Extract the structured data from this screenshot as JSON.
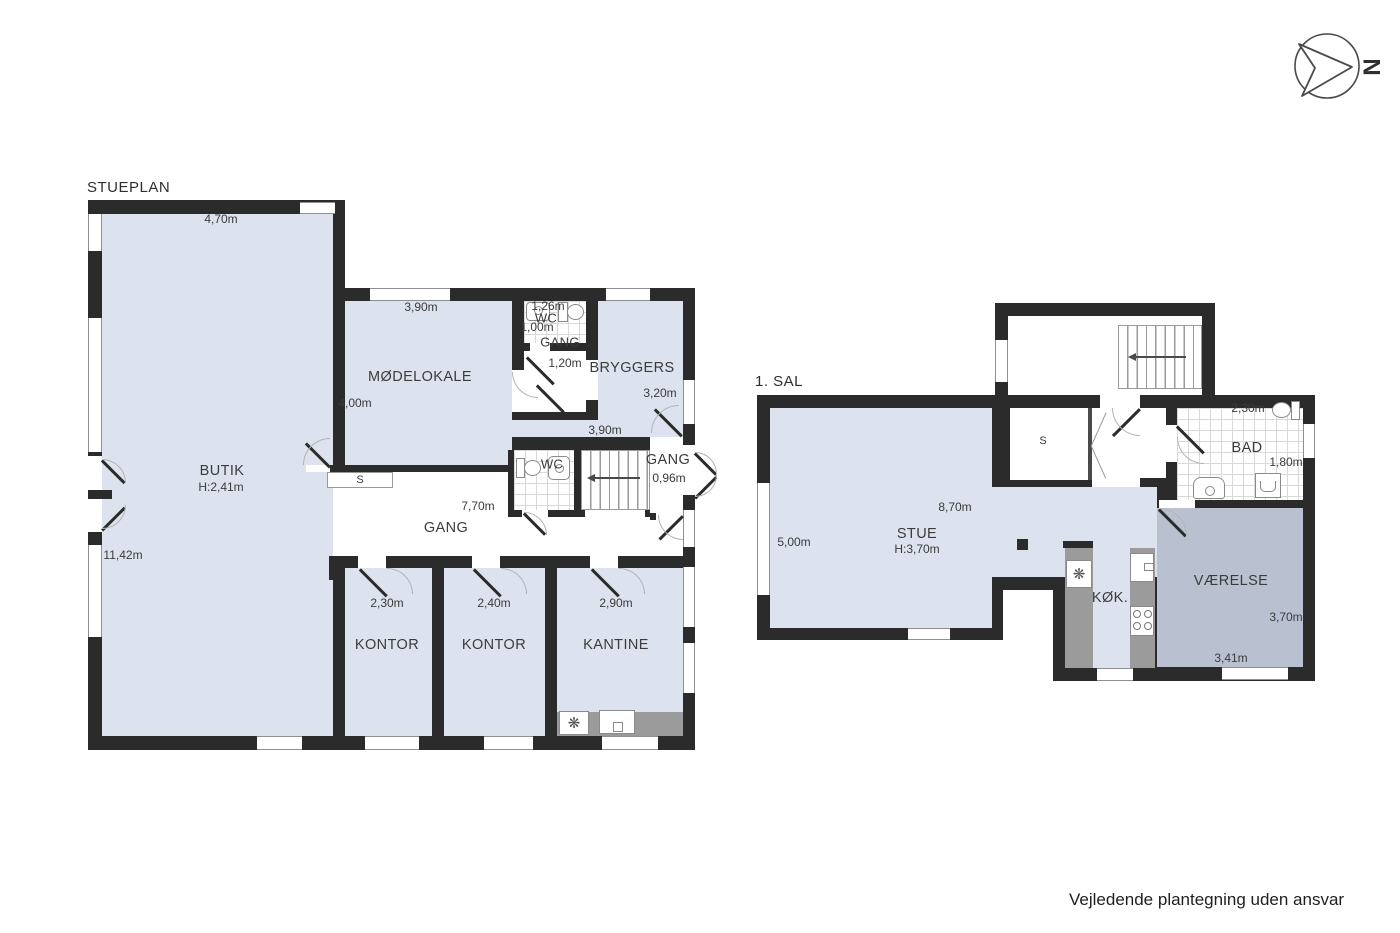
{
  "page": {
    "footer": "Vejledende plantegning uden ansvar"
  },
  "compass": {
    "letter": "N"
  },
  "colors": {
    "wall": "#2b2b2b",
    "room_light": "#dce3ee",
    "room_dark": "#b9c1d0",
    "counter": "#9b9b9b",
    "tile_line": "#d9d9d9"
  },
  "stueplan": {
    "title": "STUEPLAN",
    "butik": {
      "name": "BUTIK",
      "ceiling_height": "H:2,41m",
      "width": "4,70m",
      "depth": "11,42m"
    },
    "moedelokale": {
      "name": "MØDELOKALE",
      "width": "3,90m",
      "depth": "4,00m"
    },
    "wc_top": {
      "name": "WC",
      "width": "1,26m",
      "depth": "1,00m"
    },
    "gang_top": {
      "name": "GANG",
      "depth": "1,20m"
    },
    "bryggers": {
      "name": "BRYGGERS",
      "depth": "3,20m",
      "width": "3,90m"
    },
    "wc_mid": {
      "name": "WC"
    },
    "gang_exit": {
      "name": "GANG",
      "width": "0,96m"
    },
    "gang_main": {
      "name": "GANG",
      "width": "7,70m"
    },
    "closet": {
      "name": "S"
    },
    "kontor1": {
      "name": "KONTOR",
      "width": "2,30m"
    },
    "kontor2": {
      "name": "KONTOR",
      "width": "2,40m"
    },
    "kantine": {
      "name": "KANTINE",
      "width": "2,90m"
    }
  },
  "sal1": {
    "title": "1. SAL",
    "stue": {
      "name": "STUE",
      "ceiling_height": "H:3,70m",
      "width": "8,70m",
      "depth": "5,00m"
    },
    "closet": {
      "name": "S"
    },
    "bad": {
      "name": "BAD",
      "width": "2,30m",
      "depth": "1,80m"
    },
    "koekken": {
      "name": "KØK."
    },
    "vaerelse": {
      "name": "VÆRELSE",
      "depth": "3,70m",
      "width": "3,41m"
    }
  }
}
